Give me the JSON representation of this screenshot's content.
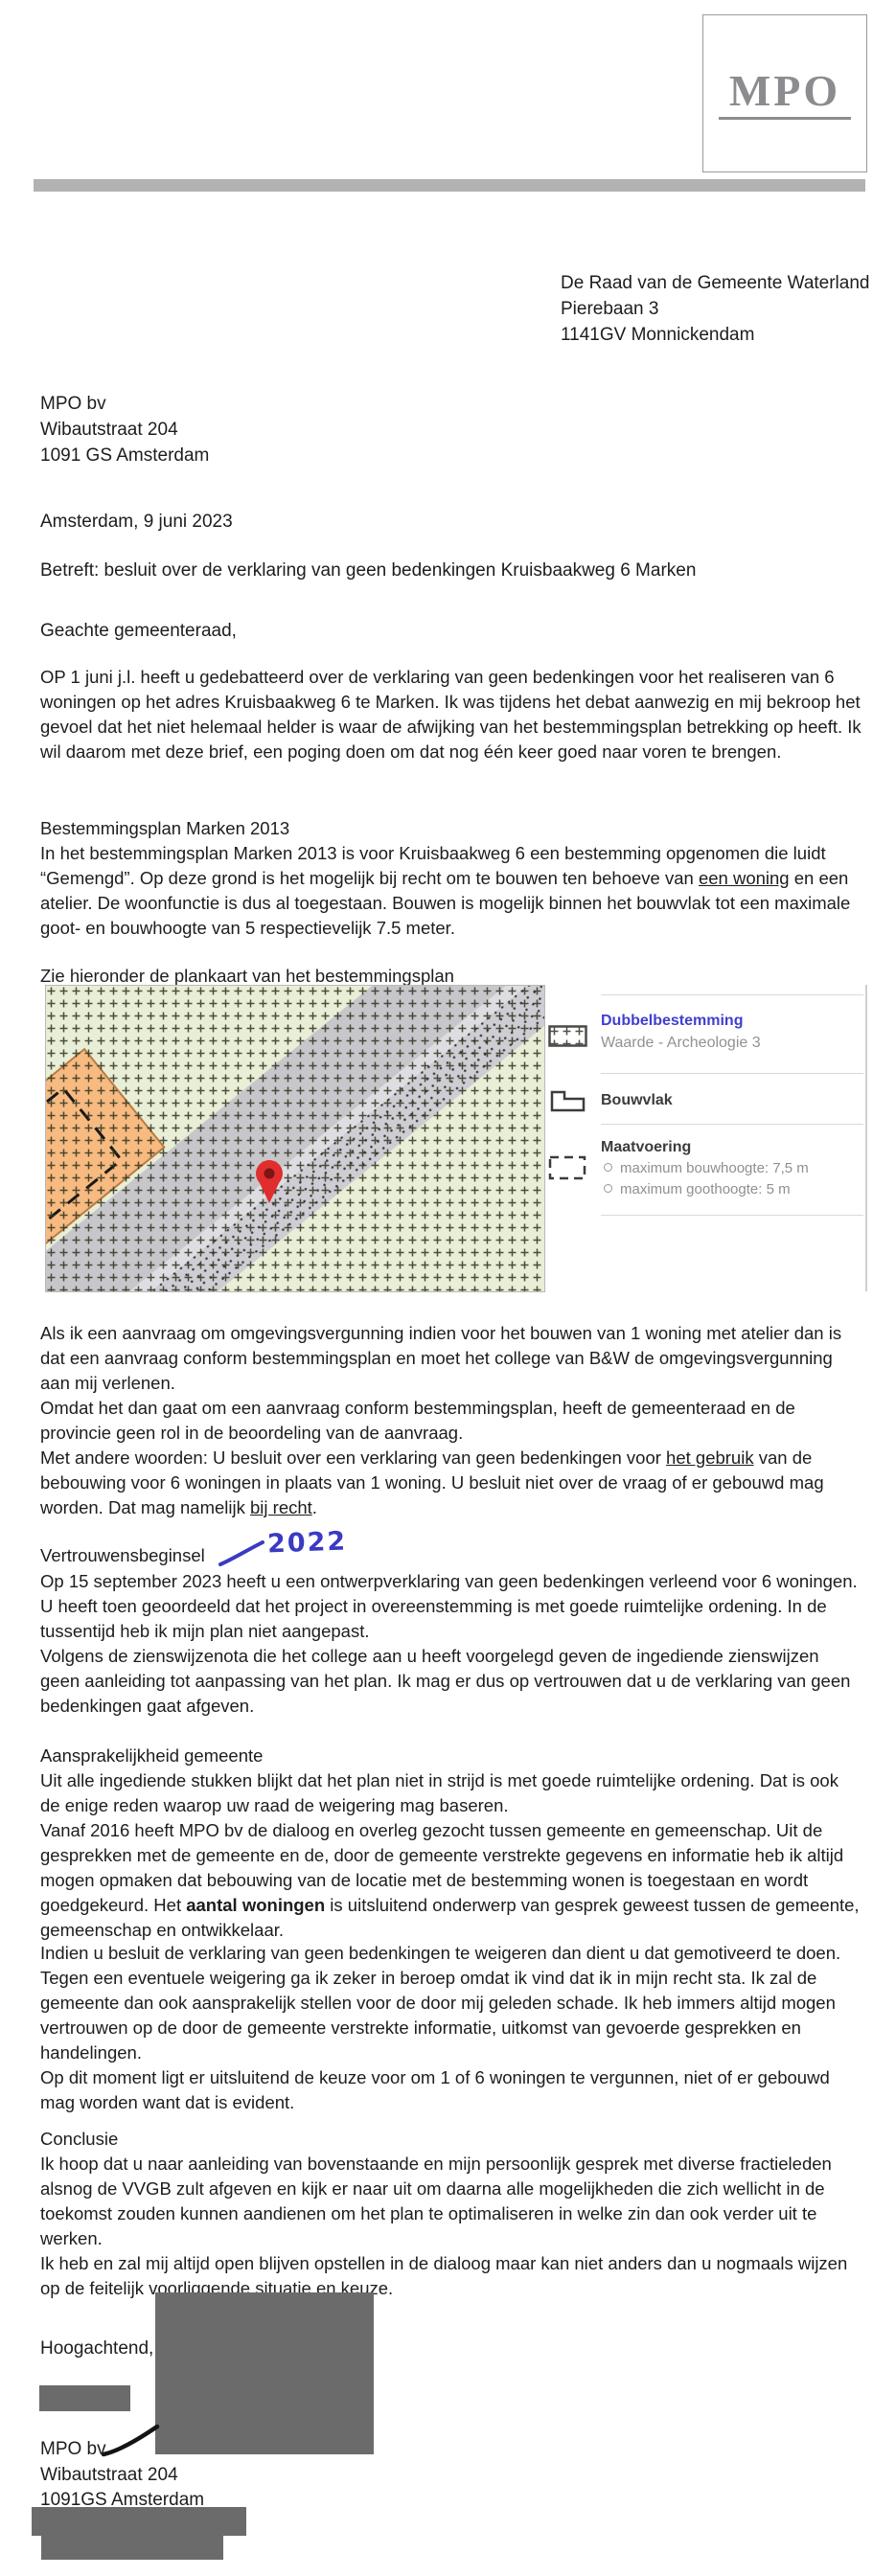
{
  "colors": {
    "annotation_blue": "#3a3ac2",
    "legend_title_blue": "#3f3fd1",
    "redaction_grey": "#6b6b6b",
    "top_bar_grey": "#b2b2b2",
    "logo_grey": "#8c8c90",
    "map_background_green": "#e9eed6",
    "map_orange_zone": "#f7ba80",
    "map_grey_band": "#c6c6cb",
    "pin_red": "#e02d2d"
  },
  "header": {
    "logo_text": "MPO"
  },
  "recipient": [
    "De Raad van de Gemeente Waterland",
    "Pierebaan 3",
    "1141GV Monnickendam"
  ],
  "sender": [
    "MPO bv",
    "Wibautstraat 204",
    "1091 GS Amsterdam"
  ],
  "letter": {
    "date_line": "Amsterdam, 9 juni 2023",
    "subject": "Betreft: besluit over de verklaring van geen bedenkingen Kruisbaakweg 6 Marken",
    "salutation": "Geachte gemeenteraad,",
    "p_intro": "OP 1 juni j.l. heeft u gedebatteerd over de verklaring van geen bedenkingen voor het realiseren van 6 woningen op het adres Kruisbaakweg 6 te Marken. Ik was tijdens het debat aanwezig en mij bekroop het gevoel dat het niet helemaal helder is waar de afwijking van het bestemmingsplan betrekking op heeft.  Ik wil daarom met deze brief, een poging doen om dat nog één keer goed naar voren te brengen.",
    "h_bestemmingsplan": "Bestemmingsplan Marken 2013",
    "p_bestemmingsplan": [
      "In het bestemmingsplan Marken 2013 is voor Kruisbaakweg 6 een bestemming opgenomen die luidt “Gemengd”. Op deze grond is het mogelijk bij recht om te bouwen ten behoeve van ",
      "een woning",
      " en een atelier. De woonfunctie is dus al toegestaan. Bouwen is mogelijk binnen het bouwvlak tot een maximale goot- en bouwhoogte van 5 respectievelijk 7.5 meter."
    ],
    "map_caption": "Zie hieronder de plankaart van het bestemmingsplan",
    "p_aanvraag": "Als ik een aanvraag om omgevingsvergunning indien voor het bouwen van 1 woning met atelier dan is dat een aanvraag conform bestemmingsplan en moet het college van B&W de omgevingsvergunning aan mij verlenen.",
    "p_omdat": "Omdat het dan gaat om een aanvraag conform bestemmingsplan, heeft de gemeenteraad en de provincie geen rol in de beoordeling van de aanvraag.",
    "p_met_andere": [
      "Met andere woorden: U besluit over een verklaring van geen bedenkingen voor ",
      "het gebruik",
      " van de bebouwing voor 6 woningen in plaats van 1 woning.  U besluit niet over de vraag of er gebouwd mag worden. Dat mag namelijk ",
      "bij recht",
      "."
    ],
    "h_vertrouwensbeginsel": "Vertrouwensbeginsel",
    "annotation_2022": "2022",
    "p_op15": "Op 15 september 2023 heeft u een ontwerpverklaring van geen bedenkingen verleend voor 6 woningen. U heeft toen geoordeeld dat het project in overeenstemming is met goede ruimtelijke ordening. In de tussentijd heb ik mijn plan niet aangepast.",
    "p_volgens": "Volgens de zienswijzenota die het college aan u heeft voorgelegd geven de ingediende zienswijzen geen aanleiding tot aanpassing van het plan. Ik mag er dus op vertrouwen dat u de verklaring van geen bedenkingen gaat afgeven.",
    "h_aansprakelijkheid": "Aansprakelijkheid gemeente",
    "p_uit_alle": "Uit alle ingediende stukken blijkt dat het plan niet in strijd is met goede ruimtelijke ordening. Dat is ook de enige reden waarop uw raad de weigering mag baseren.",
    "p_vanaf": [
      "Vanaf 2016 heeft MPO bv de dialoog en overleg gezocht tussen gemeente en gemeenschap. Uit de gesprekken met de gemeente en de, door de gemeente verstrekte gegevens en informatie heb ik altijd mogen opmaken dat bebouwing van de locatie met de bestemming wonen is toegestaan en wordt goedgekeurd. Het ",
      "aantal woningen",
      " is uitsluitend onderwerp van gesprek geweest tussen de gemeente, gemeenschap en ontwikkelaar."
    ],
    "p_indien": "Indien u besluit de verklaring van geen bedenkingen te weigeren dan dient u dat gemotiveerd te doen. Tegen een eventuele weigering ga ik zeker in beroep omdat ik vind dat ik in mijn recht sta. Ik zal de gemeente dan ook aansprakelijk stellen voor de door mij geleden schade. Ik heb immers altijd mogen vertrouwen op de door de gemeente verstrekte informatie, uitkomst van gevoerde gesprekken en handelingen.",
    "p_op_dit": "Op dit moment ligt er uitsluitend de keuze voor om 1 of 6 woningen te vergunnen, niet of er gebouwd mag worden want dat is evident.",
    "h_conclusie": "Conclusie",
    "p_ik_hoop": "Ik hoop dat u naar aanleiding van bovenstaande en mijn persoonlijk gesprek met diverse fractieleden alsnog de VVGB zult afgeven en kijk er naar uit om daarna alle mogelijkheden die zich wellicht in de toekomst zouden kunnen aandienen om het plan te optimaliseren in welke zin dan ook verder uit te werken.",
    "p_ik_heb": "Ik heb en zal mij altijd open blijven opstellen in de dialoog maar kan niet anders dan u nogmaals wijzen op de feitelijk voorliggende situatie en keuze.",
    "closing": "Hoogachtend,"
  },
  "signature_block": [
    "MPO bv",
    "Wibautstraat 204",
    "1091GS Amsterdam"
  ],
  "legend": {
    "dubbelbestemming_title": "Dubbelbestemming",
    "dubbelbestemming_sub": "Waarde - Archeologie 3",
    "bouwvlak_title": "Bouwvlak",
    "maatvoering_title": "Maatvoering",
    "maatvoering_items": [
      "maximum bouwhoogte: 7,5 m",
      "maximum goothoogte: 5 m"
    ]
  }
}
